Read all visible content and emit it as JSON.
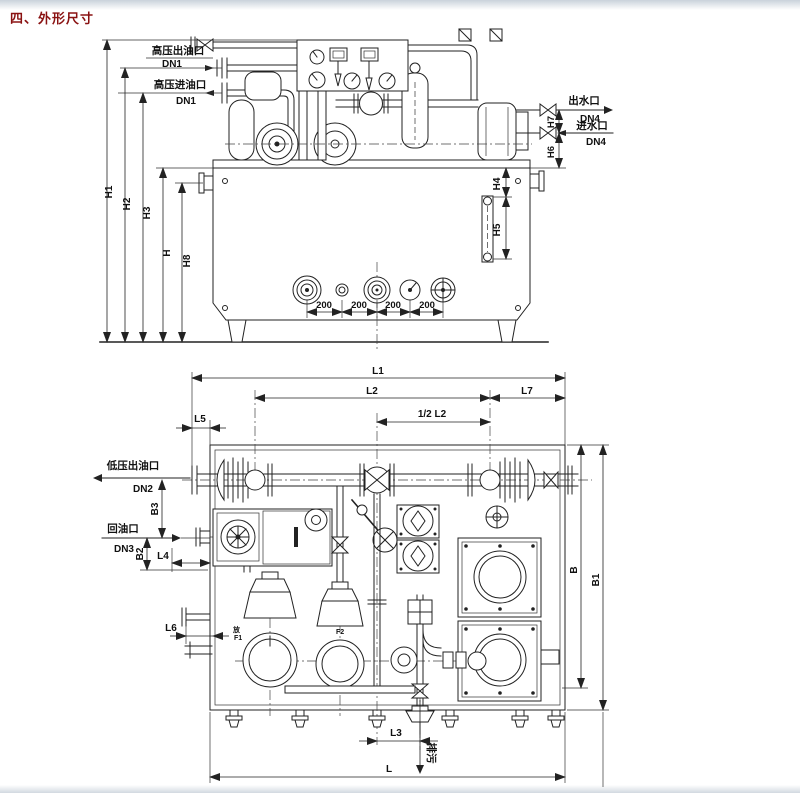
{
  "title": "四、外形尺寸",
  "front_view": {
    "ports": {
      "hp_outlet": {
        "name": "高压出油口",
        "size": "DN1"
      },
      "hp_inlet": {
        "name": "高压进油口",
        "size": "DN1"
      },
      "water_outlet": {
        "name": "出水口",
        "size": "DN4"
      },
      "water_inlet": {
        "name": "进水口",
        "size": "DN4"
      }
    },
    "dims": {
      "h1": "H1",
      "h2": "H2",
      "h3": "H3",
      "h": "H",
      "h8": "H8",
      "h4": "H4",
      "h5": "H5",
      "h6": "H6",
      "h7": "H7"
    },
    "spacings": [
      "200",
      "200",
      "200",
      "200"
    ]
  },
  "plan_view": {
    "ports": {
      "lp_outlet": {
        "name": "低压出油口",
        "size": "DN2"
      },
      "oil_return": {
        "name": "回油口",
        "size": "DN3"
      },
      "drain": {
        "name": "排污"
      }
    },
    "dims": {
      "l1": "L1",
      "l2": "L2",
      "half_l2": "1/2 L2",
      "l7": "L7",
      "l5": "L5",
      "l4": "L4",
      "l6": "L6",
      "l3": "L3",
      "l": "L",
      "b": "B",
      "b1": "B1",
      "b2": "B2",
      "b3": "B3"
    },
    "tags": {
      "f1": "F1",
      "f2": "F2",
      "drain_valve": "放"
    }
  }
}
